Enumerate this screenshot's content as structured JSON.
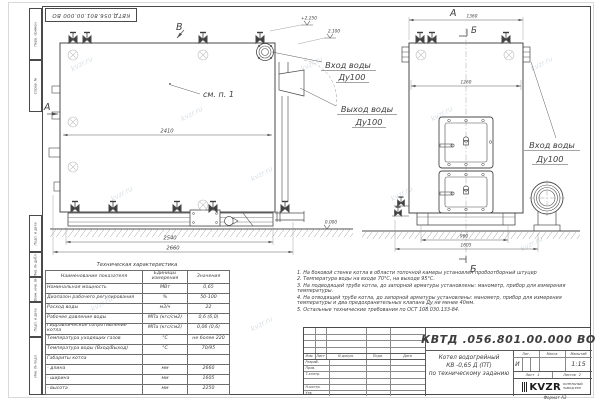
{
  "watermark": "kvzr.ru",
  "stamp_top": "КВТД.056.801.00.000 ВО",
  "frame_strip": {
    "cells": [
      "Перв. примен.",
      "Справ. №",
      "Подп. и дата",
      "Инв. № дубл.",
      "Взам. инв. №",
      "Подп. и дата",
      "Инв. № подл."
    ]
  },
  "svg_labels": {
    "view_b": "В",
    "view_a_side": "А",
    "view_a_front": "А",
    "view_b_top": "Б",
    "view_b_bottom": "Б",
    "see_item": "см. п. 1",
    "dim_2410": "2410",
    "dim_2540": "2540",
    "dim_2660": "2660",
    "dim_1360": "1360",
    "dim_1260": "1260",
    "dim_960": "960",
    "dim_1605": "1605",
    "elev_top": "+2.250",
    "elev_mid": "2.100",
    "elev_zero": "0.000",
    "inlet_water": "Вход воды",
    "outlet_water": "Выход воды",
    "dn100": "Ду100"
  },
  "spec_table": {
    "title": "Техническая характеристика",
    "col_headers": [
      "Наименование показателя",
      "Единицы измерения",
      "Значения"
    ],
    "rows": [
      {
        "name": "Номинальная мощность",
        "unit": "МВт",
        "value": "0,65"
      },
      {
        "name": "Диапазон рабочего регулирования",
        "unit": "%",
        "value": "50-100"
      },
      {
        "name": "Расход воды",
        "unit": "м3/ч",
        "value": "22"
      },
      {
        "name": "Рабочее давление воды",
        "unit": "МПа (кгс/см2)",
        "value": "0,6 (6,0)"
      },
      {
        "name": "Гидравлическое сопротивление котла",
        "unit": "МПа (кгс/см2)",
        "value": "0,06 (0,6)"
      },
      {
        "name": "Температура уходящих газов",
        "unit": "°С",
        "value": "не более 220"
      },
      {
        "name": "Температура воды (Вход/Выход)",
        "unit": "°С",
        "value": "70/95"
      },
      {
        "name": "Габариты котла",
        "unit": "",
        "value": ""
      },
      {
        "name": "- длина",
        "unit": "мм",
        "value": "2660"
      },
      {
        "name": "- ширина",
        "unit": "мм",
        "value": "1605"
      },
      {
        "name": "- высота",
        "unit": "мм",
        "value": "2250"
      }
    ]
  },
  "notes": [
    "1.  На боковой стенке котла в области топочной камеры установлен пробоотборный штуцер",
    "2.  Температура воды на входе  70°С,  на выходе  95°С.",
    "3.  На подводящей трубе котла, до запорной арматуры установлены: манометр, прибор для измерения температуры.",
    "4.  На отводящей трубе котла, до запорной арматуры установлены: манометр, прибор для измерения температуры и два предохранительных клапана Ду не менее 40мм.",
    "5.  Остальные технические требования по ОСТ 108.030.133-84."
  ],
  "title_block": {
    "doc_number": "КВТД .056.801.00.000  ВО",
    "product_line1": "Котел водогрейный",
    "product_line2": "КВ -0,65  Д  (ПТ)",
    "product_line3": "по техническому заданию",
    "header_cols": [
      "Изм.",
      "Лист",
      "N докум.",
      "Подп.",
      "Дата"
    ],
    "sign_rows": [
      "Разраб.",
      "Пров.",
      "Т.контр.",
      "Н.контр.",
      "Утв."
    ],
    "lit_header": "Лит.",
    "mass_header": "Масса",
    "scale_header": "Масштаб",
    "lit_value": "И",
    "scale_value": "1:15",
    "sheet_label": "Лист",
    "sheet_value": "1",
    "sheets_label": "Листов",
    "sheets_value": "2",
    "logo_text": "KVZR",
    "logo_sub_line1": "КОТЕЛЬНЫЙ",
    "logo_sub_line2": "ЗАВОД РЭП",
    "format_label": "Формат А3"
  }
}
